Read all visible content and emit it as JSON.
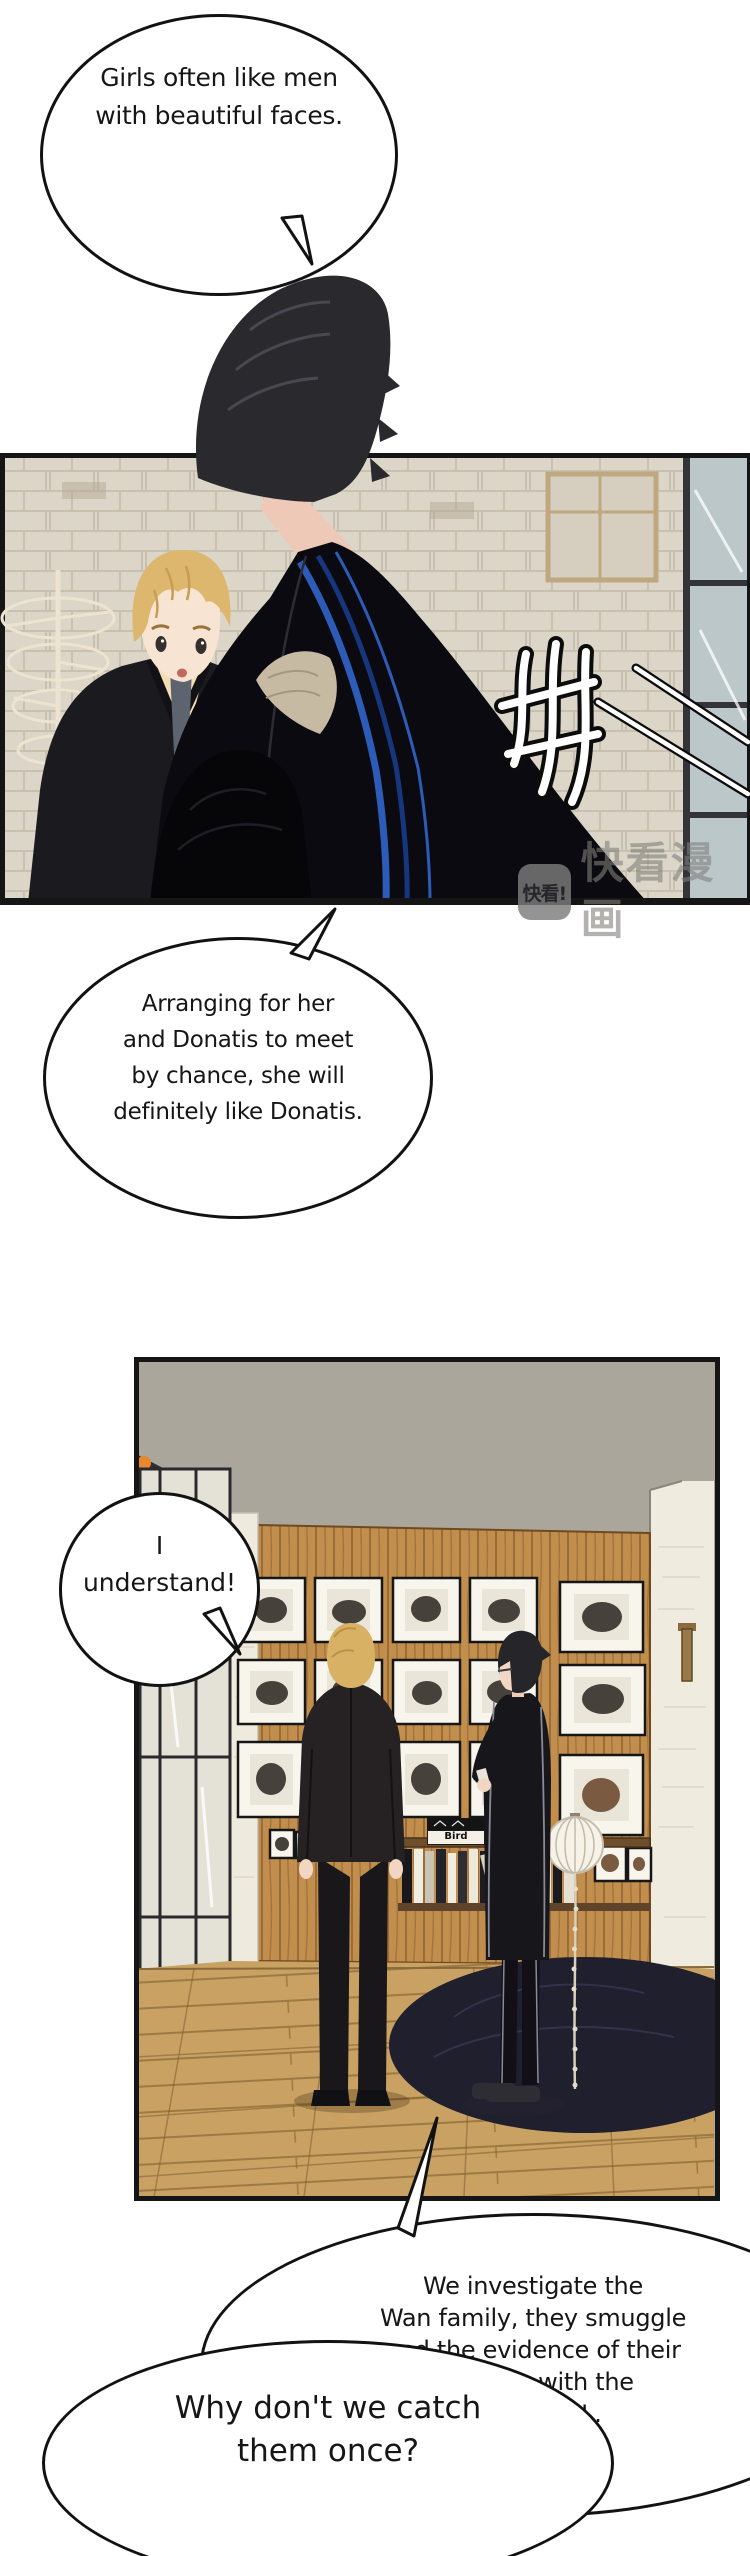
{
  "comic": {
    "bubble1": {
      "lines": [
        "Girls often like men",
        "with beautiful faces."
      ]
    },
    "bubble2": {
      "lines": [
        "Arranging for her",
        "and Donatis to meet",
        "by chance, she will",
        "definitely like Donatis."
      ]
    },
    "bubble3": {
      "lines": [
        "I",
        "understand!"
      ]
    },
    "bubble4": {
      "lines": [
        "We investigate the",
        "Wan family, they smuggle",
        "and the evidence of their",
        "dealings with the",
        "enemy in L."
      ]
    },
    "bubble5": {
      "lines": [
        "Why don't we catch",
        "them once?"
      ]
    }
  },
  "watermark": {
    "logo_text": "快看!",
    "brand_text": "快看漫画"
  },
  "panel2_extras": {
    "book_label": "Bird"
  },
  "icons": {
    "sfx_name": "brush-stroke-sfx",
    "lamp_name": "orange-lamp-icon"
  },
  "colors": {
    "brick_wall": "#dcd6c8",
    "wood_wall": "#c28e4e",
    "floor": "#c9a162",
    "rug": "#1f1f2e",
    "blond_hair": "#dcb76d",
    "black_hair": "#2a2a2e",
    "coat_stripe": "#2d5cb8",
    "watermark_gray": "#8a8a8a",
    "bubble_border": "#121212"
  }
}
